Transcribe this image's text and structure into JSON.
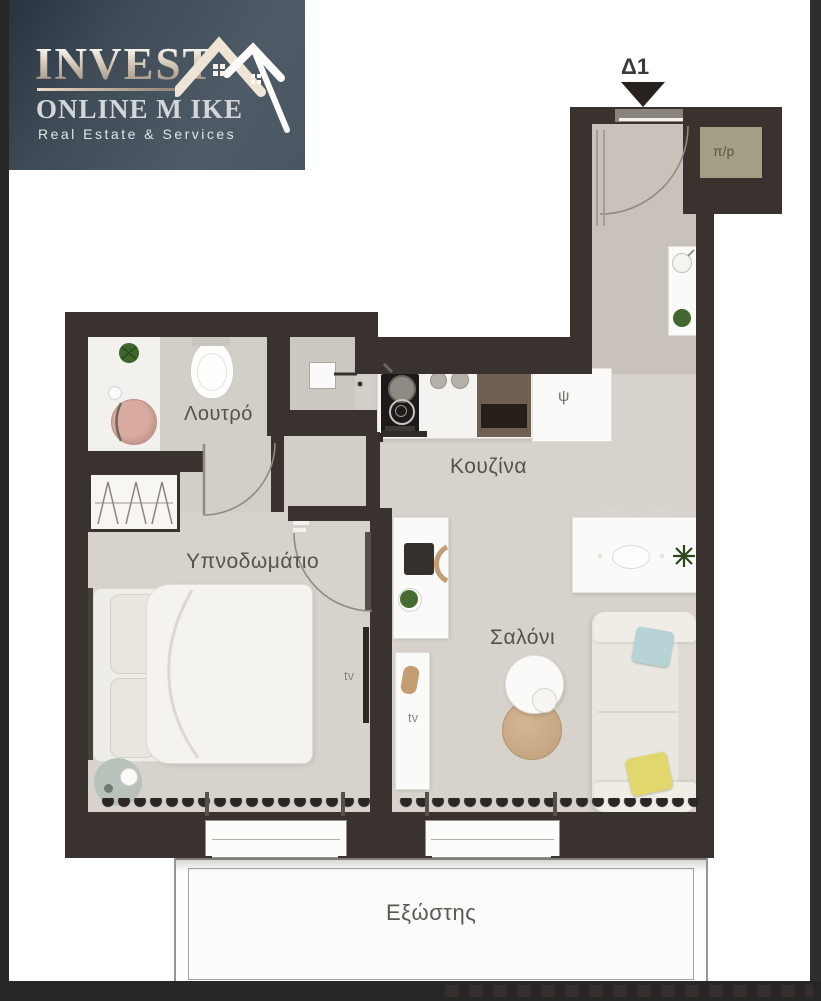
{
  "logo": {
    "title": "INVEST",
    "subtitle": "ONLINE M IKE",
    "tagline": "Real Estate & Services"
  },
  "plan": {
    "unit_label": "Δ1",
    "rooms": {
      "bathroom": "Λουτρό",
      "kitchen": "Κουζίνα",
      "bedroom": "Υπνοδωμάτιο",
      "living_room": "Σαλόνι",
      "balcony": "Εξώστης"
    },
    "labels": {
      "closet": "π/p",
      "fridge": "ψ",
      "tv_bedroom": "tv",
      "tv_living": "tv"
    }
  },
  "colors": {
    "wall": "#3a322e",
    "floor": "#d7d3cc",
    "floor_hall": "#c8c2ba",
    "logo_background": "#4e5a66",
    "closet_fill": "#a49e84",
    "pillow_yellow": "#e2d76c",
    "pillow_blue": "#b7d3d5",
    "sink_pink": "#d9aaa0",
    "rug_sage": "#b8c2bb"
  }
}
